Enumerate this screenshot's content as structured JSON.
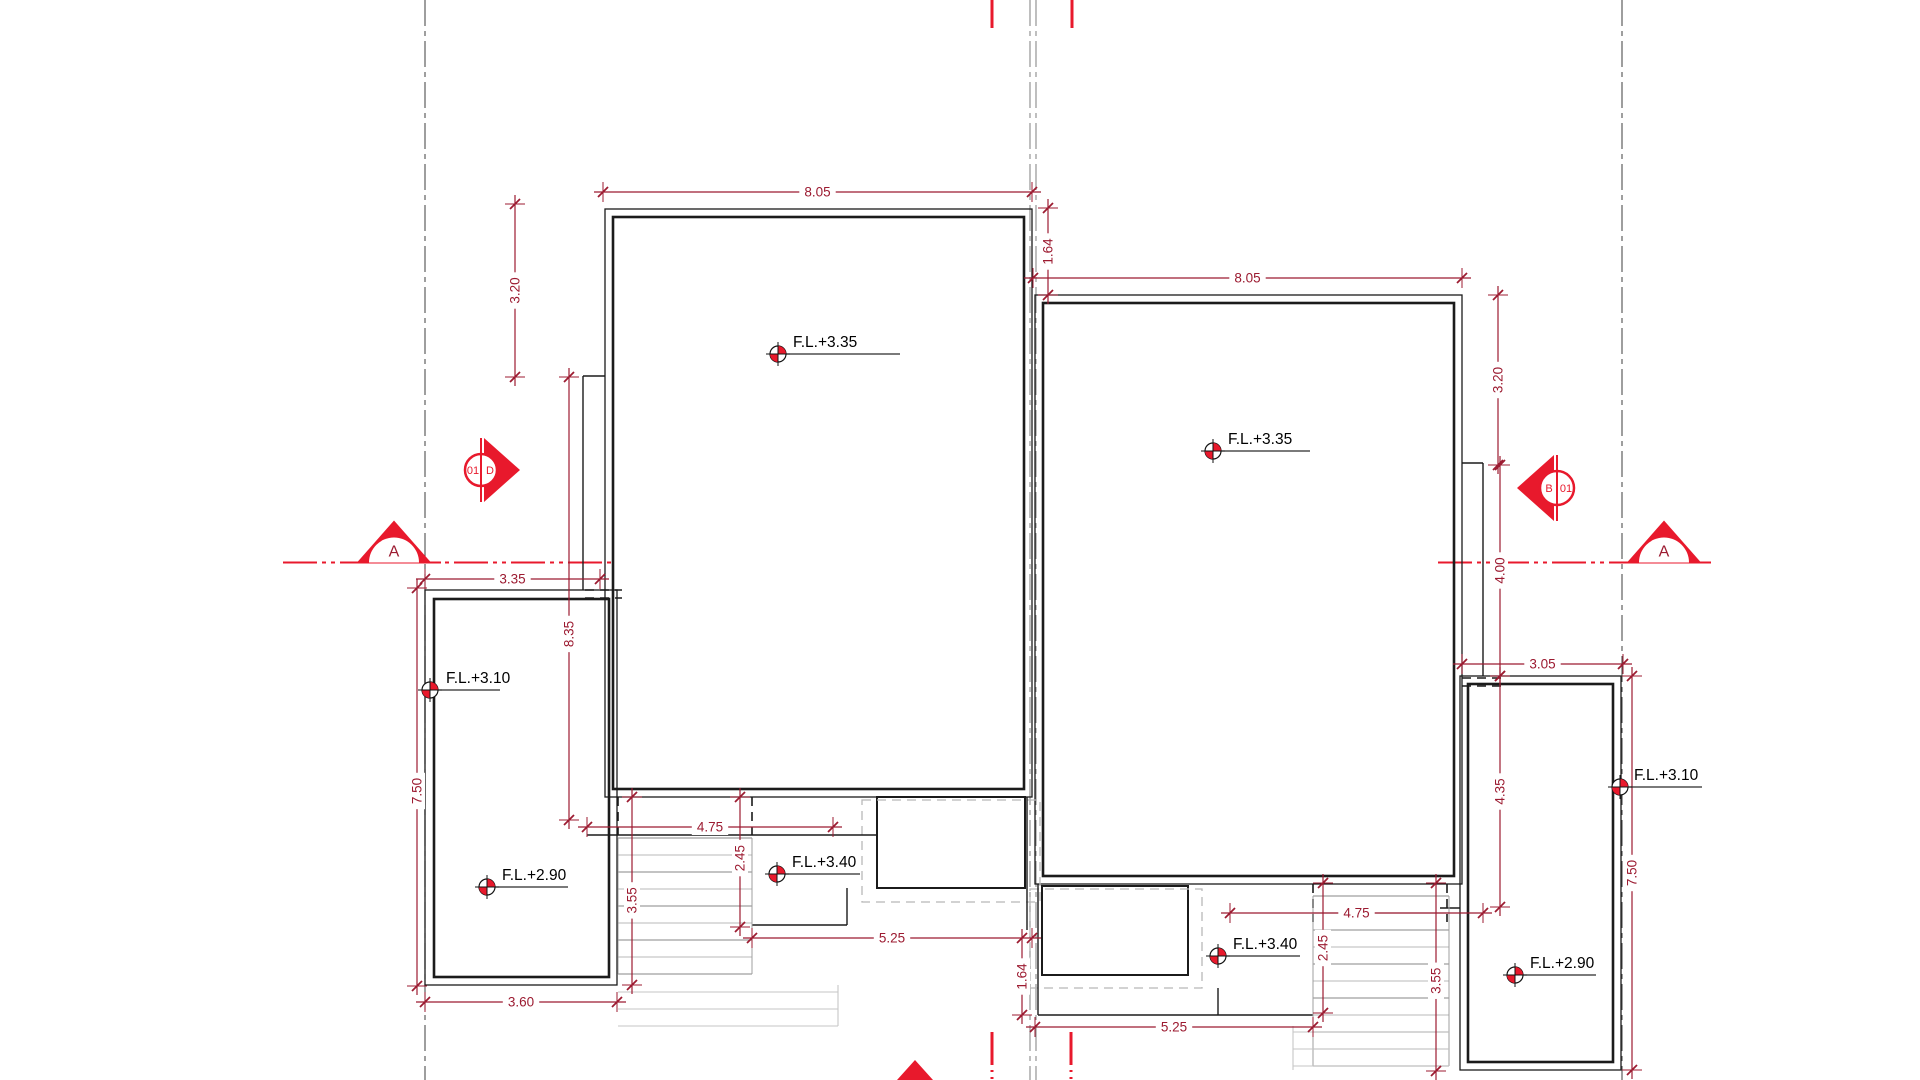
{
  "meta": {
    "drawing_type": "architectural roof / floor plan",
    "width": 1920,
    "height": 1080
  },
  "colors": {
    "wall": "#1b1b1b",
    "dim": "#9c1b31",
    "red": "#e8192c",
    "centerline": "#4f4f4f",
    "centerline_gray": "#8a8a8a",
    "stair": "#9f9f9f",
    "stair_light": "#c6c6c6",
    "hidden": "#1b1b1b",
    "dash_gray": "#b8b8b8",
    "white": "#ffffff"
  },
  "section_markers": {
    "left": {
      "circle_left_label": "01",
      "circle_right_label": "D",
      "cx": 481,
      "cy": 470,
      "r": 16,
      "dir": "right"
    },
    "right": {
      "circle_left_label": "B",
      "circle_right_label": "01",
      "cx": 1557,
      "cy": 488,
      "r": 17,
      "dir": "left"
    }
  },
  "section_arrows": [
    {
      "label": "A",
      "cx": 394,
      "base_y": 562.5,
      "half_w": 37,
      "h": 42,
      "r": 25
    },
    {
      "label": "A",
      "cx": 1664,
      "base_y": 562.5,
      "half_w": 37,
      "h": 42,
      "r": 25
    }
  ],
  "section_line": {
    "y": 562.5,
    "segments": [
      [
        283,
        612
      ],
      [
        1438,
        1702
      ]
    ]
  },
  "centerlines": [
    {
      "x": 425,
      "y1": 0,
      "y2": 1080,
      "gray": false
    },
    {
      "x": 1030,
      "y1": 0,
      "y2": 1080,
      "gray": true
    },
    {
      "x": 1036,
      "y1": 0,
      "y2": 1080,
      "gray": true
    },
    {
      "x": 1622,
      "y1": 0,
      "y2": 1080,
      "gray": false
    }
  ],
  "red_ticks": [
    [
      992,
      0,
      28
    ],
    [
      1072,
      0,
      28
    ],
    [
      992,
      1032,
      1063
    ],
    [
      1071,
      1032,
      1063
    ]
  ],
  "red_dotted_ticks": [
    [
      992,
      1063,
      1080
    ],
    [
      1071,
      1063,
      1080
    ]
  ],
  "bottom_triangle": [
    [
      897,
      1080
    ],
    [
      933,
      1080
    ],
    [
      915,
      1060
    ]
  ],
  "buildings": [
    {
      "name": "building-left-main",
      "outer": [
        605,
        209,
        1032,
        797
      ],
      "inner": [
        613,
        217,
        1024,
        789
      ]
    },
    {
      "name": "building-right-main",
      "outer": [
        1035,
        295,
        1462,
        884
      ],
      "inner": [
        1043,
        303,
        1454,
        876
      ]
    },
    {
      "name": "porch-left",
      "outer": [
        425,
        590,
        617,
        985
      ],
      "inner": [
        434,
        599,
        609,
        977
      ]
    },
    {
      "name": "porch-right",
      "outer": [
        1460,
        676,
        1621,
        1070
      ],
      "inner": [
        1468,
        684,
        1613,
        1062
      ]
    }
  ],
  "step_rects": [
    [
      877,
      797,
      1025,
      888
    ],
    [
      1042,
      886,
      1188,
      975
    ]
  ],
  "dashed_gray_rects": [
    [
      862,
      800,
      1040,
      902
    ],
    [
      1030,
      889,
      1202,
      988
    ]
  ],
  "solid_lines": [
    [
      583,
      376,
      583,
      590
    ],
    [
      583,
      376,
      605,
      376
    ],
    [
      587,
      835,
      877,
      835
    ],
    [
      752,
      925,
      847,
      925
    ],
    [
      847,
      888,
      847,
      925
    ],
    [
      1027,
      797,
      1027,
      930
    ],
    [
      1038,
      884,
      1038,
      1015
    ],
    [
      1038,
      1015,
      1313,
      1015
    ],
    [
      1218,
      988,
      1218,
      1015
    ],
    [
      1462,
      463,
      1483,
      463
    ],
    [
      1483,
      463,
      1483,
      676
    ],
    [
      1440,
      908,
      1460,
      908
    ]
  ],
  "hidden_dashed_lines": [
    [
      585,
      590,
      622,
      590
    ],
    [
      585,
      598,
      622,
      598
    ],
    [
      1462,
      678,
      1503,
      678
    ],
    [
      1462,
      686,
      1503,
      686
    ],
    [
      618,
      797,
      618,
      835
    ],
    [
      752,
      797,
      752,
      835
    ],
    [
      1313,
      884,
      1313,
      922
    ],
    [
      1447,
      884,
      1447,
      922
    ]
  ],
  "stair_sets": [
    {
      "x1": 618,
      "x2": 752,
      "y": 838,
      "step": 17,
      "n": 9
    },
    {
      "x1": 1313,
      "x2": 1449,
      "y": 896,
      "step": 17,
      "n": 11
    }
  ],
  "light_lines": [
    [
      618,
      992,
      838,
      992
    ],
    [
      618,
      1009,
      838,
      1009
    ],
    [
      618,
      1026,
      838,
      1026
    ],
    [
      838,
      985,
      838,
      1026
    ],
    [
      1293,
      1032,
      1449,
      1032
    ],
    [
      1293,
      1049,
      1449,
      1049
    ],
    [
      1293,
      1066,
      1449,
      1066
    ],
    [
      1293,
      1026,
      1293,
      1070
    ]
  ],
  "dimensions": [
    {
      "x1": 603,
      "y1": 192,
      "x2": 1032,
      "y2": 192,
      "label": "8.05"
    },
    {
      "x1": 515,
      "y1": 204,
      "x2": 515,
      "y2": 377,
      "label": "3.20"
    },
    {
      "x1": 1048,
      "y1": 208,
      "x2": 1048,
      "y2": 295,
      "label": "1.64"
    },
    {
      "x1": 569,
      "y1": 377,
      "x2": 569,
      "y2": 820,
      "label": "8.35",
      "t": 0.58
    },
    {
      "x1": 425,
      "y1": 579,
      "x2": 600,
      "y2": 579,
      "label": "3.35"
    },
    {
      "x1": 417,
      "y1": 588,
      "x2": 417,
      "y2": 986,
      "label": "7.50",
      "t": 0.51
    },
    {
      "x1": 425,
      "y1": 1002,
      "x2": 617,
      "y2": 1002,
      "label": "3.60"
    },
    {
      "x1": 587,
      "y1": 827,
      "x2": 833,
      "y2": 827,
      "label": "4.75"
    },
    {
      "x1": 632,
      "y1": 797,
      "x2": 632,
      "y2": 985,
      "label": "3.55",
      "t": 0.55
    },
    {
      "x1": 740,
      "y1": 797,
      "x2": 740,
      "y2": 927,
      "label": "2.45",
      "t": 0.47
    },
    {
      "x1": 752,
      "y1": 938,
      "x2": 1032,
      "y2": 938,
      "label": "5.25"
    },
    {
      "x1": 1022,
      "y1": 938,
      "x2": 1022,
      "y2": 1015,
      "label": "1.64"
    },
    {
      "x1": 1033,
      "y1": 278,
      "x2": 1462,
      "y2": 278,
      "label": "8.05"
    },
    {
      "x1": 1498,
      "y1": 295,
      "x2": 1498,
      "y2": 465,
      "label": "3.20"
    },
    {
      "x1": 1500,
      "y1": 465,
      "x2": 1500,
      "y2": 676,
      "label": "4.00"
    },
    {
      "x1": 1462,
      "y1": 664,
      "x2": 1623,
      "y2": 664,
      "label": "3.05"
    },
    {
      "x1": 1500,
      "y1": 676,
      "x2": 1500,
      "y2": 907,
      "label": "4.35"
    },
    {
      "x1": 1632,
      "y1": 676,
      "x2": 1632,
      "y2": 1070,
      "label": "7.50"
    },
    {
      "x1": 1230,
      "y1": 913,
      "x2": 1483,
      "y2": 913,
      "label": "4.75"
    },
    {
      "x1": 1323,
      "y1": 883,
      "x2": 1323,
      "y2": 1013,
      "label": "2.45"
    },
    {
      "x1": 1436,
      "y1": 883,
      "x2": 1436,
      "y2": 1071,
      "label": "3.55",
      "t": 0.52
    },
    {
      "x1": 1035,
      "y1": 1027,
      "x2": 1313,
      "y2": 1027,
      "label": "5.25"
    }
  ],
  "fl_markers": [
    {
      "cx": 778,
      "cy": 354,
      "label": "F.L.+3.35",
      "tx": 793,
      "ty": 347,
      "x2": 900
    },
    {
      "cx": 1213,
      "cy": 451,
      "label": "F.L.+3.35",
      "tx": 1228,
      "ty": 444,
      "x2": 1310
    },
    {
      "cx": 430,
      "cy": 690,
      "label": "F.L.+3.10",
      "tx": 446,
      "ty": 683,
      "x2": 500
    },
    {
      "cx": 1620,
      "cy": 787,
      "label": "F.L.+3.10",
      "tx": 1634,
      "ty": 780,
      "x2": 1702
    },
    {
      "cx": 487,
      "cy": 887,
      "label": "F.L.+2.90",
      "tx": 502,
      "ty": 880,
      "x2": 568
    },
    {
      "cx": 1515,
      "cy": 975,
      "label": "F.L.+2.90",
      "tx": 1530,
      "ty": 968,
      "x2": 1596
    },
    {
      "cx": 777,
      "cy": 874,
      "label": "F.L.+3.40",
      "tx": 792,
      "ty": 867,
      "x2": 860
    },
    {
      "cx": 1218,
      "cy": 956,
      "label": "F.L.+3.40",
      "tx": 1233,
      "ty": 949,
      "x2": 1300
    }
  ]
}
